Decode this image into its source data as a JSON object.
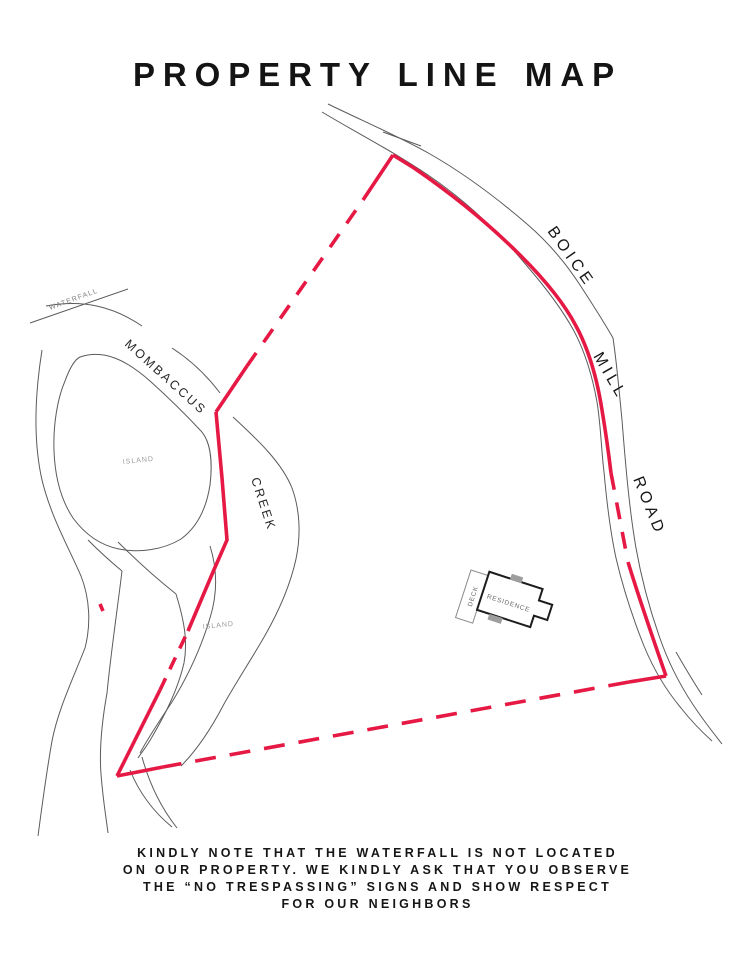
{
  "page": {
    "title": "PROPERTY LINE MAP"
  },
  "map": {
    "labels": {
      "waterfall": "WATERFALL",
      "creek_name_upper": "MOMBACCUS",
      "creek_name_lower": "CREEK",
      "island_upper": "ISLAND",
      "island_lower": "ISLAND",
      "road_word_1": "BOICE",
      "road_word_2": "MILL",
      "road_word_3": "ROAD",
      "residence": "RESIDENCE",
      "deck": "DECK"
    },
    "colors": {
      "property_line": "#e51944",
      "map_lines": "#5b5b5b",
      "building_outline": "#1c1c1c",
      "building_accent": "#9e9e9e",
      "faint_label": "#9a9a9a"
    }
  },
  "note": {
    "lines": [
      "KINDLY NOTE THAT THE WATERFALL IS NOT LOCATED",
      "ON OUR PROPERTY. WE KINDLY ASK THAT YOU OBSERVE",
      "THE “NO TRESPASSING” SIGNS AND SHOW RESPECT",
      "FOR OUR NEIGHBORS"
    ]
  }
}
